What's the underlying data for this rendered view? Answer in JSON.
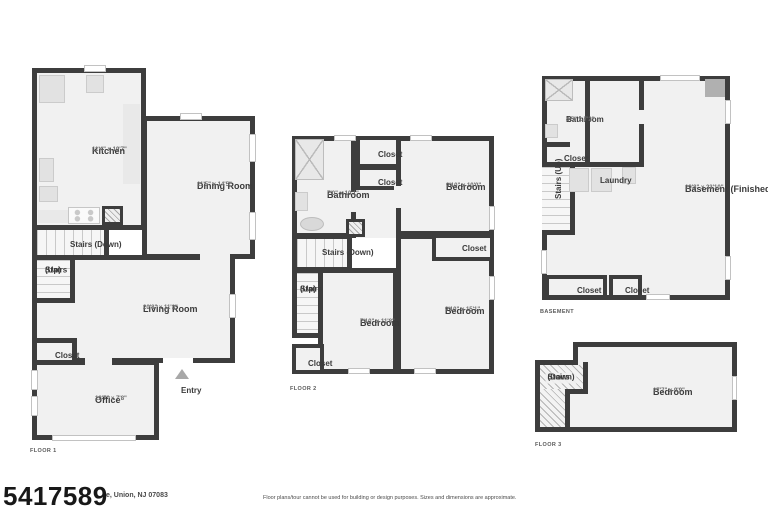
{
  "colors": {
    "wall": "#3d3d3d",
    "floor": "#f1f1f1",
    "fixture": "#e2e2e2",
    "entry_arrow": "#a8a8a8"
  },
  "footer": {
    "mls_number": "5417589",
    "address_visible": "e, Union, NJ 07083",
    "disclaimer": "Floor plans/tour cannot be used for building or design purposes. Sizes and dimensions are approximate."
  },
  "floor1": {
    "label": "FLOOR 1",
    "kitchen": {
      "name": "Kitchen",
      "dims": "11'4\" x 19'7\""
    },
    "dining_room": {
      "name": "Dining Room",
      "dims": "11'5\" x 14'5\""
    },
    "stairs_down": {
      "name": "Stairs (Down)"
    },
    "stairs_up": {
      "line1": "Stairs",
      "line2": "(Up)"
    },
    "living_room": {
      "name": "Living Room",
      "dims": "20'8\" x 11'3\""
    },
    "closet": {
      "name": "Closet"
    },
    "office": {
      "name": "Office",
      "dims": "12'7\" x 7'8\""
    },
    "entry": {
      "name": "Entry"
    }
  },
  "floor2": {
    "label": "FLOOR 2",
    "bathroom": {
      "name": "Bathroom",
      "dims": "7'0\" x 10'1\""
    },
    "closet_top": {
      "name": "Closet"
    },
    "closet_mid": {
      "name": "Closet"
    },
    "bedroom_top": {
      "name": "Bedroom",
      "dims": "9'10\" x 10'0\""
    },
    "stairs_down": {
      "name": "Stairs (Down)"
    },
    "stairs_up": {
      "line1": "Stairs",
      "line2": "(Up)"
    },
    "bedroom_left": {
      "name": "Bedroom",
      "dims": "7'10\" x 11'8\""
    },
    "bedroom_right": {
      "name": "Bedroom",
      "dims": "9'10\" x 15'1\""
    },
    "closet_right": {
      "name": "Closet"
    },
    "closet_bottom": {
      "name": "Closet"
    }
  },
  "basement": {
    "label": "BASEMENT",
    "bathroom": {
      "name": "Bathroom",
      "dims": "4'5\" x 7'2\""
    },
    "closet_top": {
      "name": "Closet"
    },
    "stairs_up": {
      "name": "Stairs (Up)"
    },
    "laundry": {
      "name": "Laundry"
    },
    "main": {
      "name": "Basement (Finished)",
      "dims": "19'8\" x 23'10\""
    },
    "closet_bottom_left": {
      "name": "Closet"
    },
    "closet_bottom_right": {
      "name": "Closet"
    }
  },
  "floor3": {
    "label": "FLOOR 3",
    "stairs_down": {
      "line1": "Stairs",
      "line2": "(Down)"
    },
    "bedroom": {
      "name": "Bedroom",
      "dims": "17'7\" x 9'9\""
    }
  }
}
